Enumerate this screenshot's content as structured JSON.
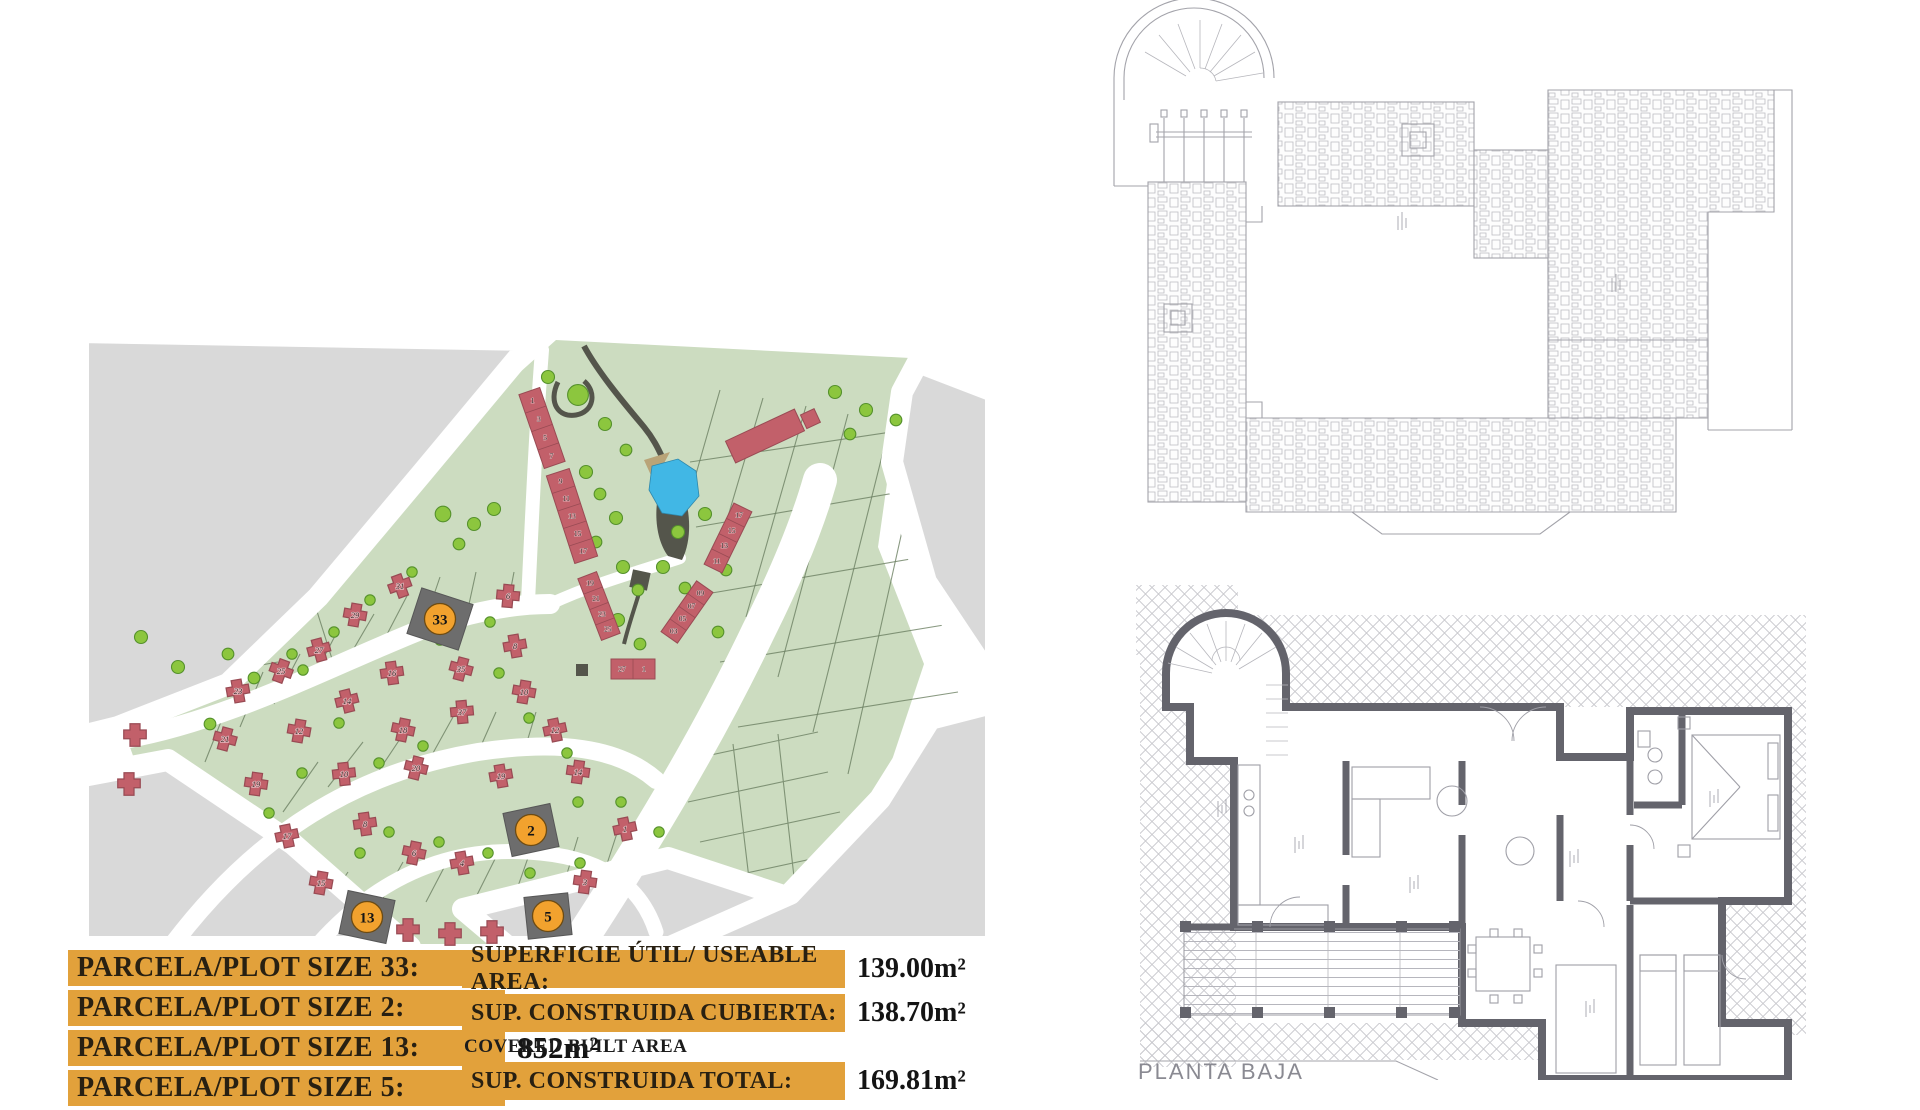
{
  "tables": {
    "plot_sizes": [
      {
        "label": "PARCELA/PLOT SIZE 33:",
        "value": "847m²"
      },
      {
        "label": "PARCELA/PLOT SIZE 2:",
        "value": "855m²"
      },
      {
        "label": "PARCELA/PLOT SIZE 13:",
        "value": "852m²"
      },
      {
        "label": "PARCELA/PLOT SIZE 5:",
        "value": "845m²"
      }
    ],
    "areas": [
      {
        "label": "SUPERFICIE ÚTIL/ USEABLE AREA:",
        "value": "139.00m²",
        "sublabel": ""
      },
      {
        "label": "SUP. CONSTRUIDA CUBIERTA:",
        "value": "138.70m²",
        "sublabel": "COVERED BUILT AREA"
      },
      {
        "label": "SUP. CONSTRUIDA TOTAL:",
        "value": "169.81m²",
        "sublabel": ""
      }
    ]
  },
  "floor_plans": {
    "ground_floor_label": "PLANTA BAJA"
  },
  "site_plan": {
    "colors": {
      "table_bar": "#E2A13B",
      "highlight_circle": "#F2A22E",
      "highlight_plot": "#6D6D6D",
      "house_red": "#C2606A",
      "parcel_green": "#CCDCC0",
      "surround_gray": "#D9D9D9",
      "road_white": "#FFFFFF",
      "pool_blue": "#41B7E5",
      "tree_green": "#8CC63E",
      "wall_gray": "#64646C"
    },
    "highlighted_plots": [
      {
        "n": "33",
        "x": 362,
        "y": 287,
        "rot": 18,
        "w": 54,
        "h": 48
      },
      {
        "n": "2",
        "x": 453,
        "y": 498,
        "rot": -12,
        "w": 48,
        "h": 44
      },
      {
        "n": "13",
        "x": 289,
        "y": 585,
        "rot": 12,
        "w": 48,
        "h": 44
      },
      {
        "n": "5",
        "x": 470,
        "y": 584,
        "rot": -6,
        "w": 44,
        "h": 42
      }
    ],
    "townhouse_rows": [
      {
        "units": [
          "1",
          "3",
          "5",
          "7"
        ],
        "x": 464,
        "y": 96,
        "rot": -19,
        "w": 22,
        "h": 78
      },
      {
        "units": [
          "9",
          "11",
          "13",
          "15",
          "17"
        ],
        "x": 494,
        "y": 184,
        "rot": -18,
        "w": 24,
        "h": 92
      },
      {
        "units": [
          "17",
          "15",
          "13",
          "11"
        ],
        "x": 650,
        "y": 206,
        "rot": 26,
        "w": 20,
        "h": 68
      },
      {
        "units": [
          "09",
          "07",
          "05",
          "03"
        ],
        "x": 609,
        "y": 280,
        "rot": 35,
        "w": 20,
        "h": 62
      },
      {
        "units": [
          "19",
          "21",
          "23",
          "25"
        ],
        "x": 521,
        "y": 274,
        "rot": -21,
        "w": 20,
        "h": 66
      },
      {
        "units": [
          "27",
          "1"
        ],
        "x": 555,
        "y": 337,
        "rot": 0,
        "w": 44,
        "h": 20,
        "horizontal": true
      }
    ],
    "plots": [
      {
        "n": "21",
        "x": 147,
        "y": 407,
        "rot": 15
      },
      {
        "n": "23",
        "x": 160,
        "y": 359,
        "rot": -10
      },
      {
        "n": "25",
        "x": 203,
        "y": 339,
        "rot": 20
      },
      {
        "n": "27",
        "x": 241,
        "y": 318,
        "rot": -15
      },
      {
        "n": "29",
        "x": 277,
        "y": 283,
        "rot": 10
      },
      {
        "n": "31",
        "x": 322,
        "y": 254,
        "rot": -20
      },
      {
        "n": "6",
        "x": 430,
        "y": 264,
        "rot": 5
      },
      {
        "n": "8",
        "x": 437,
        "y": 314,
        "rot": -10
      },
      {
        "n": "35",
        "x": 383,
        "y": 337,
        "rot": 15
      },
      {
        "n": "37",
        "x": 384,
        "y": 380,
        "rot": -5
      },
      {
        "n": "10",
        "x": 446,
        "y": 360,
        "rot": 10
      },
      {
        "n": "12",
        "x": 477,
        "y": 398,
        "rot": -12
      },
      {
        "n": "14",
        "x": 500,
        "y": 440,
        "rot": 8
      },
      {
        "n": "16",
        "x": 314,
        "y": 341,
        "rot": -8
      },
      {
        "n": "18",
        "x": 325,
        "y": 398,
        "rot": 12
      },
      {
        "n": "14",
        "x": 269,
        "y": 369,
        "rot": -14
      },
      {
        "n": "12",
        "x": 221,
        "y": 399,
        "rot": 10
      },
      {
        "n": "10",
        "x": 266,
        "y": 442,
        "rot": -6
      },
      {
        "n": "20",
        "x": 338,
        "y": 436,
        "rot": 14
      },
      {
        "n": "19",
        "x": 423,
        "y": 444,
        "rot": -10
      },
      {
        "n": "19",
        "x": 178,
        "y": 452,
        "rot": 8
      },
      {
        "n": "17",
        "x": 209,
        "y": 504,
        "rot": -12
      },
      {
        "n": "15",
        "x": 243,
        "y": 551,
        "rot": 10
      },
      {
        "n": "8",
        "x": 287,
        "y": 492,
        "rot": -8
      },
      {
        "n": "6",
        "x": 336,
        "y": 521,
        "rot": 12
      },
      {
        "n": "4",
        "x": 384,
        "y": 531,
        "rot": -10
      },
      {
        "n": "3",
        "x": 507,
        "y": 550,
        "rot": 8
      },
      {
        "n": "1",
        "x": 547,
        "y": 497,
        "rot": -12
      },
      {
        "n": "",
        "x": 57,
        "y": 403,
        "rot": 0
      },
      {
        "n": "",
        "x": 51,
        "y": 452,
        "rot": 0
      },
      {
        "n": "",
        "x": 330,
        "y": 598,
        "rot": 0
      },
      {
        "n": "",
        "x": 372,
        "y": 602,
        "rot": 0
      },
      {
        "n": "",
        "x": 414,
        "y": 600,
        "rot": 0
      }
    ],
    "apartment_block": {
      "x": 687,
      "y": 104,
      "rot": -25,
      "w": 76,
      "h": 24
    },
    "trees": [
      [
        470,
        45,
        1
      ],
      [
        500,
        63,
        1.6
      ],
      [
        527,
        92,
        1
      ],
      [
        548,
        118,
        0.9
      ],
      [
        508,
        140,
        1
      ],
      [
        522,
        162,
        0.9
      ],
      [
        538,
        186,
        1
      ],
      [
        518,
        210,
        0.9
      ],
      [
        545,
        235,
        1
      ],
      [
        560,
        258,
        0.9
      ],
      [
        540,
        288,
        1
      ],
      [
        562,
        312,
        0.9
      ],
      [
        585,
        235,
        1
      ],
      [
        607,
        256,
        0.9
      ],
      [
        600,
        200,
        1
      ],
      [
        627,
        182,
        1
      ],
      [
        648,
        238,
        0.9
      ],
      [
        640,
        300,
        0.9
      ],
      [
        365,
        182,
        1.2
      ],
      [
        396,
        192,
        1
      ],
      [
        381,
        212,
        0.9
      ],
      [
        416,
        177,
        1
      ],
      [
        132,
        392,
        0.9
      ],
      [
        176,
        346,
        0.9
      ],
      [
        214,
        322,
        0.8
      ],
      [
        256,
        300,
        0.8
      ],
      [
        292,
        268,
        0.8
      ],
      [
        334,
        240,
        0.8
      ],
      [
        362,
        308,
        0.8
      ],
      [
        412,
        290,
        0.8
      ],
      [
        421,
        341,
        0.8
      ],
      [
        451,
        386,
        0.8
      ],
      [
        489,
        421,
        0.8
      ],
      [
        301,
        431,
        0.8
      ],
      [
        345,
        414,
        0.8
      ],
      [
        261,
        391,
        0.8
      ],
      [
        224,
        441,
        0.8
      ],
      [
        191,
        481,
        0.8
      ],
      [
        282,
        521,
        0.8
      ],
      [
        311,
        500,
        0.8
      ],
      [
        361,
        510,
        0.8
      ],
      [
        410,
        521,
        0.8
      ],
      [
        452,
        541,
        0.8
      ],
      [
        502,
        531,
        0.8
      ],
      [
        500,
        470,
        0.8
      ],
      [
        543,
        470,
        0.8
      ],
      [
        581,
        500,
        0.8
      ],
      [
        63,
        305,
        1
      ],
      [
        100,
        335,
        1
      ],
      [
        150,
        322,
        0.9
      ],
      [
        225,
        338,
        0.8
      ],
      [
        757,
        60,
        1
      ],
      [
        788,
        78,
        1
      ],
      [
        772,
        102,
        0.9
      ],
      [
        818,
        88,
        0.9
      ]
    ]
  }
}
